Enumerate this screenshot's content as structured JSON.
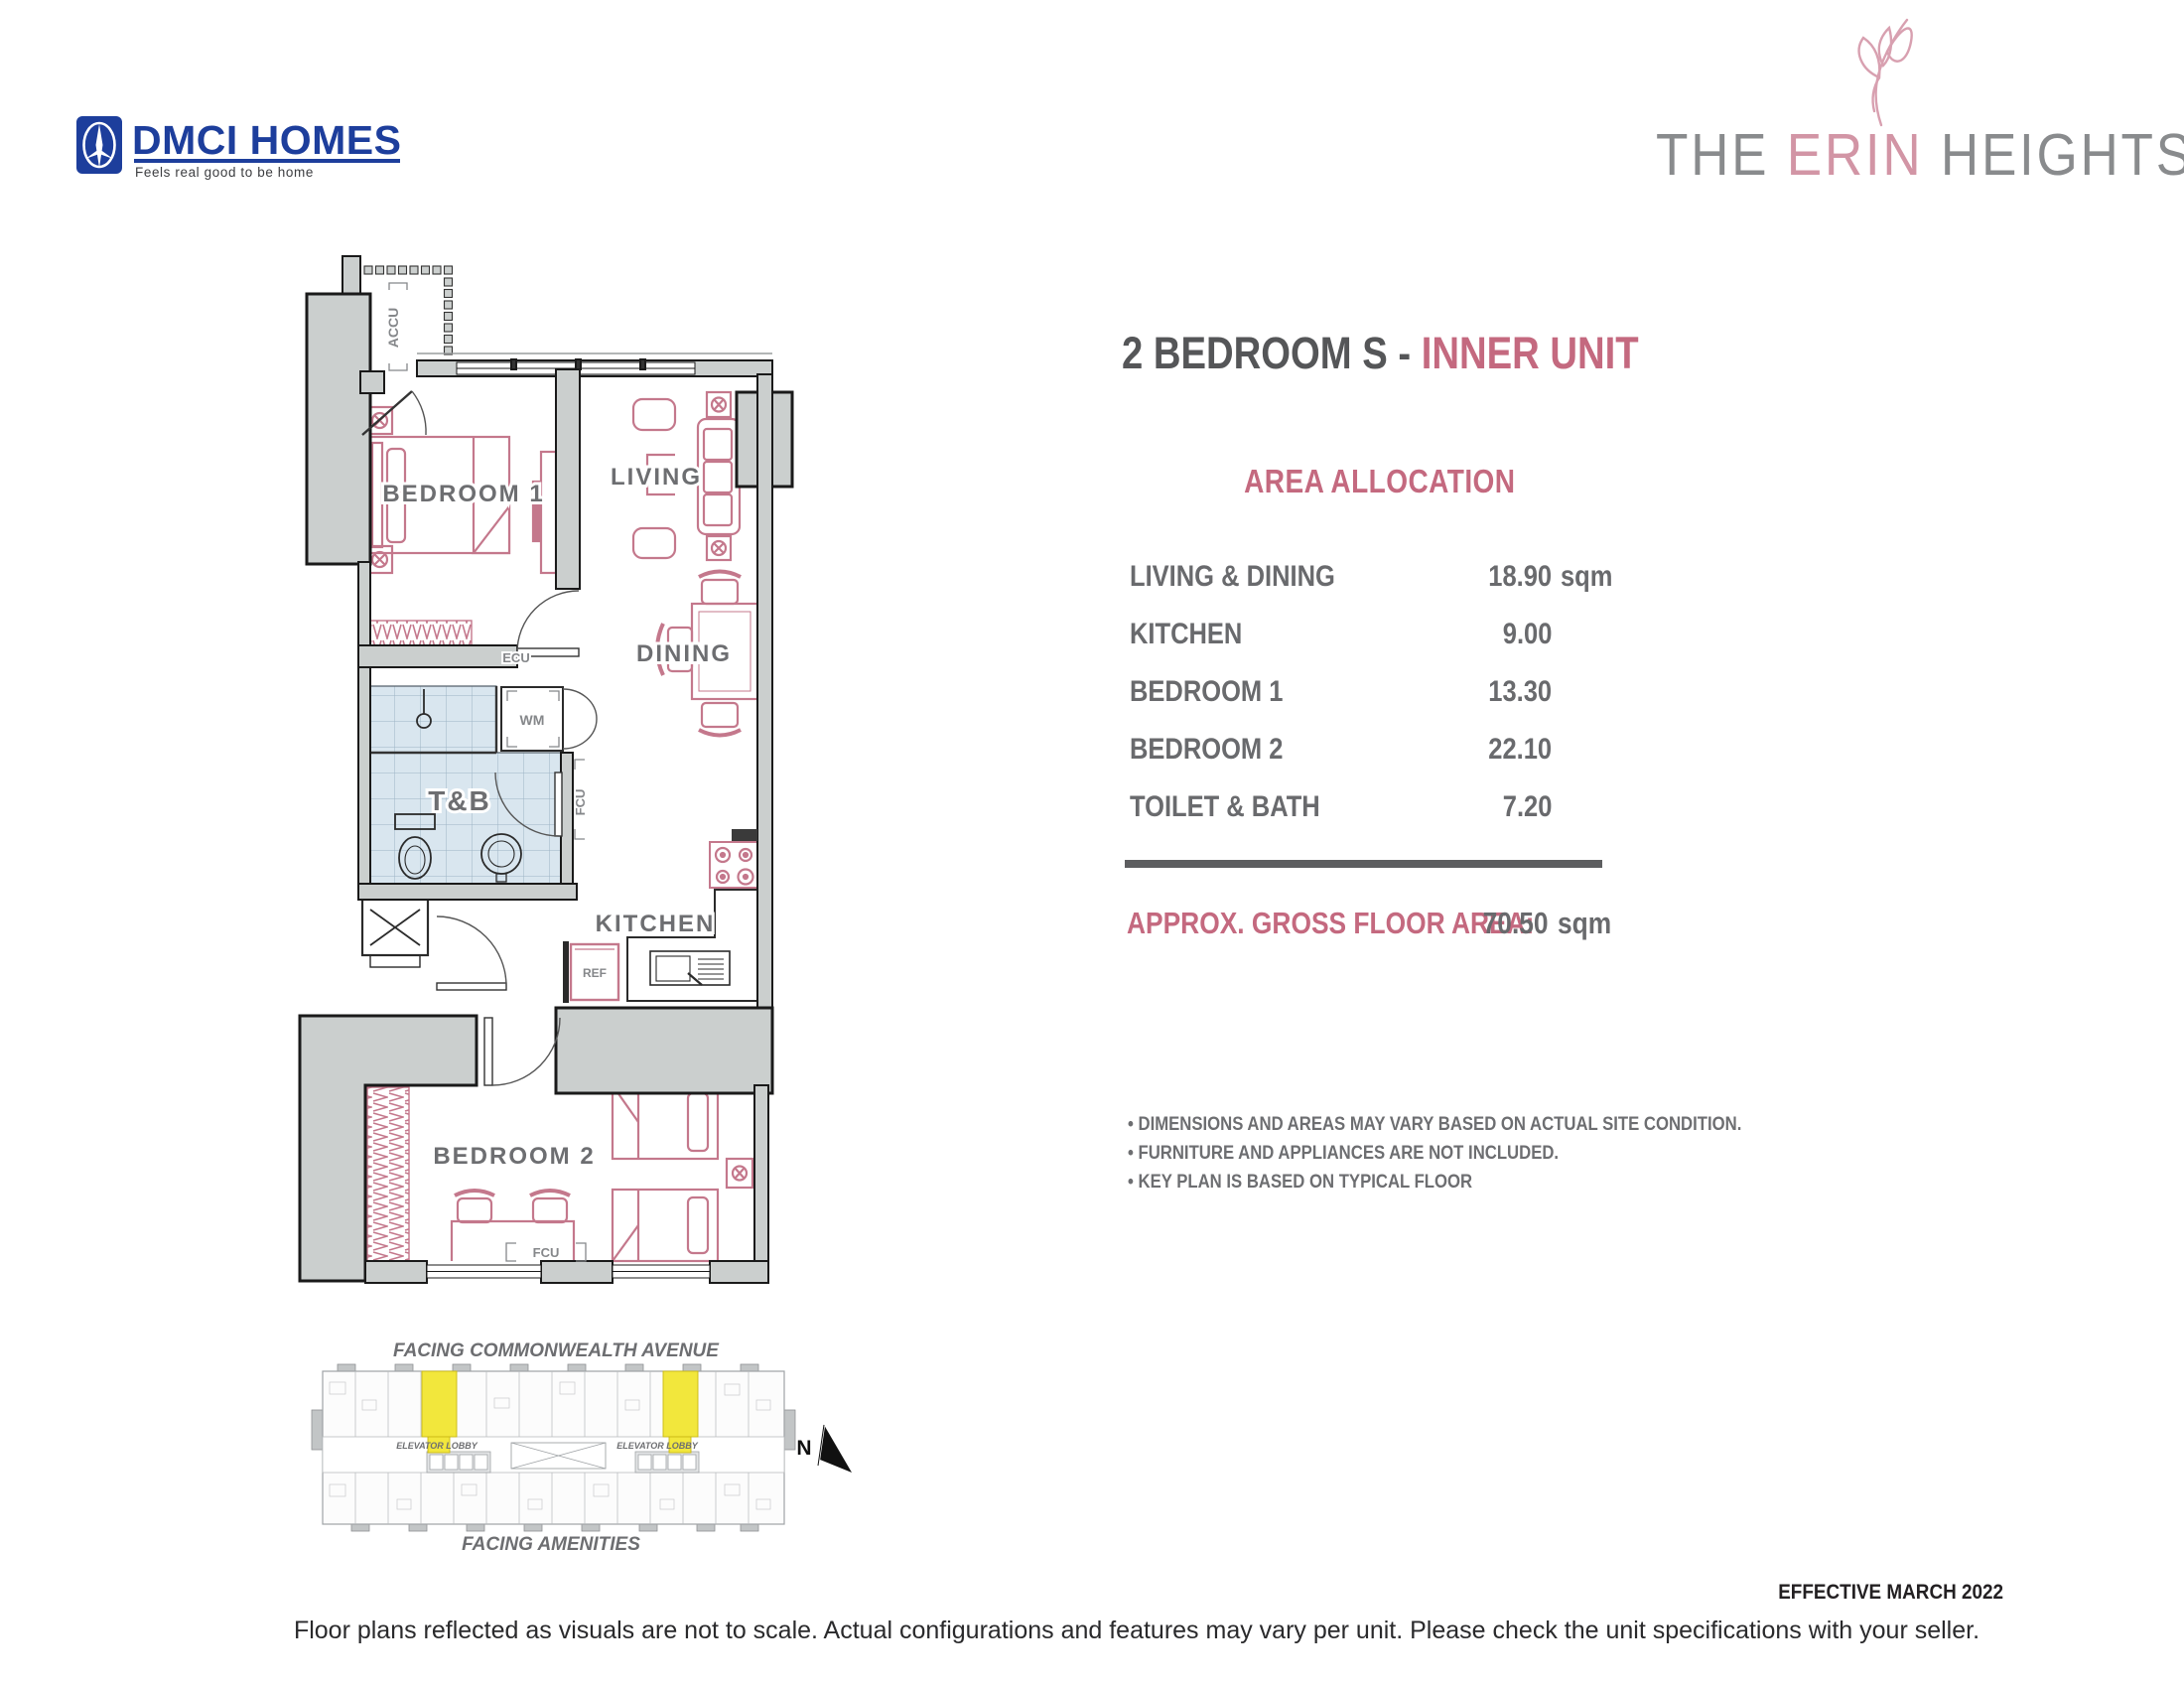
{
  "dmci_logo": {
    "name": "DMCI HOMES",
    "tagline": "Feels real good to be home",
    "blue": "#1d3e9c"
  },
  "erin_logo": {
    "the": "THE ",
    "erin": "ERIN",
    "heights": " HEIGHTS",
    "gray": "#898b8d",
    "pink": "#d295a5"
  },
  "title": {
    "main": "2 BEDROOM S - ",
    "highlight": "INNER UNIT"
  },
  "accent_color": "#c4697f",
  "text_gray": "#6d6e71",
  "area_allocation": {
    "heading": "AREA ALLOCATION",
    "rows": [
      {
        "label": "LIVING & DINING",
        "value": "18.90",
        "unit": "sqm"
      },
      {
        "label": "KITCHEN",
        "value": "9.00",
        "unit": ""
      },
      {
        "label": "BEDROOM 1",
        "value": "13.30",
        "unit": ""
      },
      {
        "label": "BEDROOM 2",
        "value": "22.10",
        "unit": ""
      },
      {
        "label": "TOILET & BATH",
        "value": "7.20",
        "unit": ""
      }
    ],
    "gross_label": "APPROX. GROSS FLOOR AREA:",
    "gross_value": "70.50",
    "gross_unit": "sqm"
  },
  "notes": [
    "• DIMENSIONS AND AREAS MAY VARY BASED ON ACTUAL SITE CONDITION.",
    "• FURNITURE AND APPLIANCES ARE NOT INCLUDED.",
    "• KEY PLAN IS BASED ON TYPICAL FLOOR"
  ],
  "floor_plan": {
    "wall_color": "#cbcfce",
    "furniture_pink": "#c4788c",
    "tile_blue": "#d9e6ef",
    "rooms": {
      "bedroom1": "BEDROOM 1",
      "living": "LIVING",
      "tb": "T&B",
      "dining": "DINING",
      "kitchen": "KITCHEN",
      "bedroom2": "BEDROOM 2"
    },
    "labels": {
      "accu": "ACCU",
      "wm": "WM",
      "ecu": "ECU",
      "fcu_hall": "FCU",
      "fcu_bedroom2": "FCU",
      "ref": "REF"
    }
  },
  "key_plan": {
    "top_label": "FACING COMMONWEALTH AVENUE",
    "bottom_label": "FACING AMENITIES",
    "elevator_label_left": "ELEVATOR LOBBY",
    "elevator_label_right": "ELEVATOR LOBBY",
    "north": "N",
    "highlight_color": "#f2e73c"
  },
  "footer": {
    "effective": "EFFECTIVE MARCH 2022",
    "disclaimer": "Floor plans reflected as visuals are not to scale. Actual configurations and features may vary per unit. Please check the unit specifications with your seller."
  }
}
